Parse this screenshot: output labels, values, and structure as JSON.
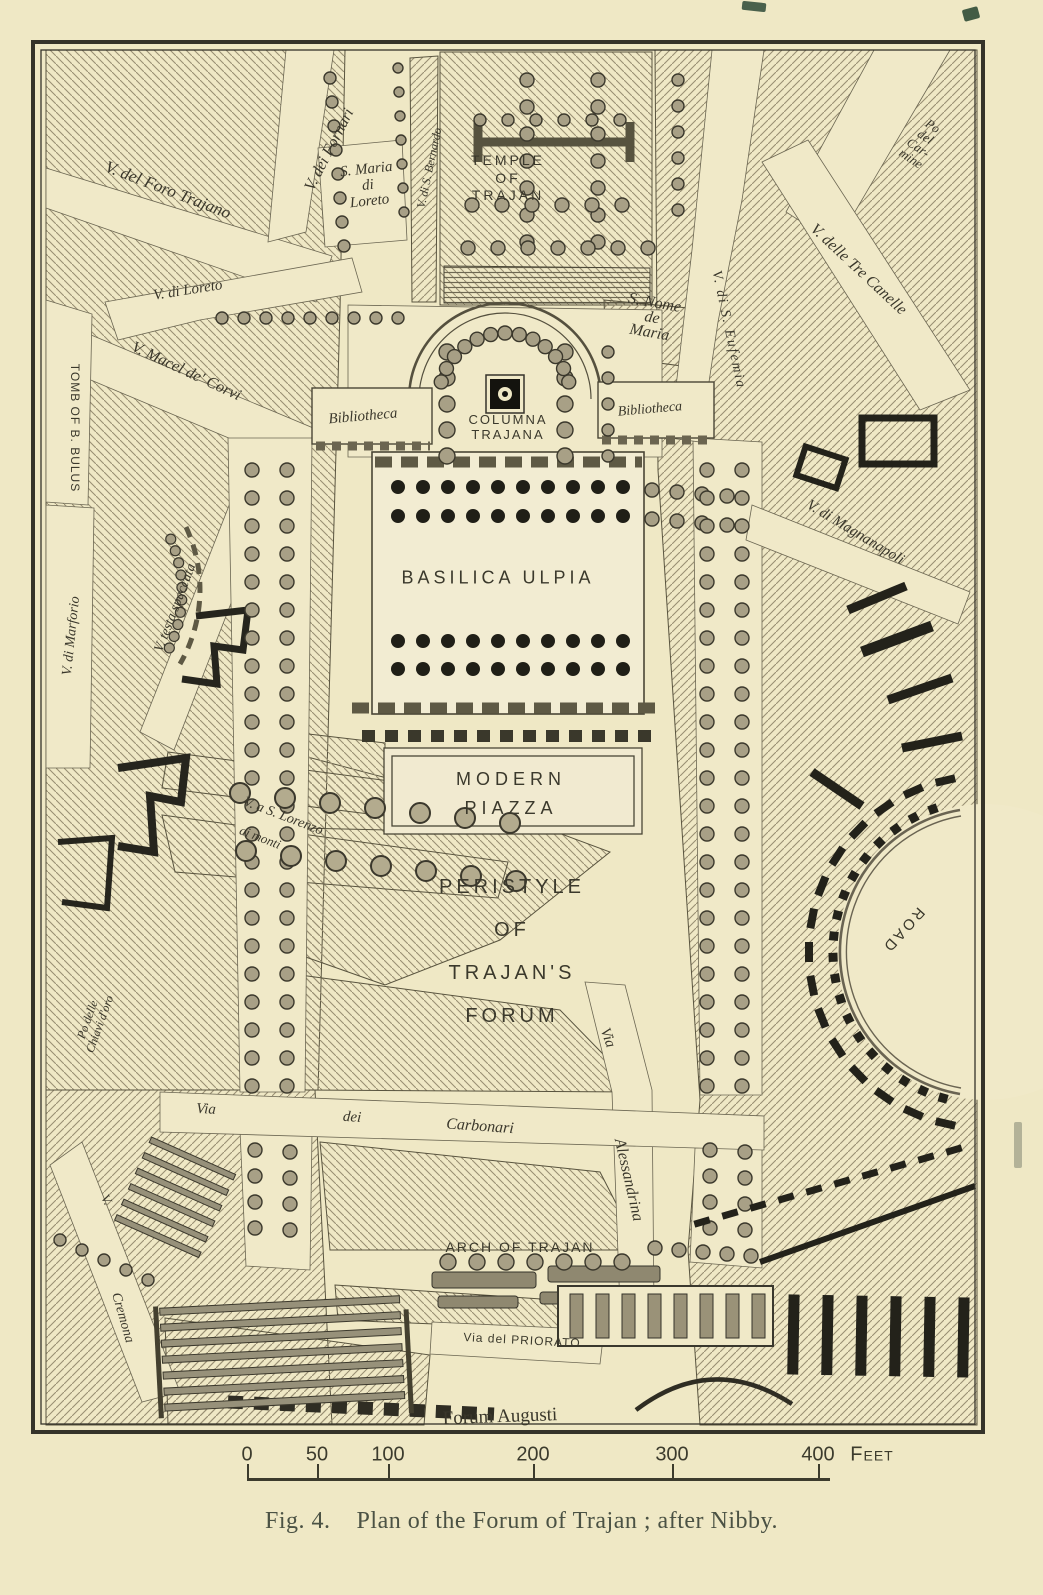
{
  "colors": {
    "paper": "#efe8c5",
    "ink": "#35332a",
    "caption_ink": "#4b5244",
    "hatch": "#978d72",
    "black_structures": "#23221a"
  },
  "figure": {
    "fig_label": "Fig. 4.",
    "caption": "Plan of the Forum of Trajan ; after Nibby."
  },
  "map": {
    "labels": [
      {
        "id": "foro-trajano",
        "text": "V. del Foro Trajano",
        "x": 168,
        "y": 190,
        "rot": 21,
        "size": 17,
        "style": "i"
      },
      {
        "id": "fornari",
        "text": "V. dei Fornari",
        "x": 330,
        "y": 150,
        "rot": -63,
        "size": 16,
        "style": "i"
      },
      {
        "id": "s-maria-di-loreto",
        "text": "S. Maria\ndi\nLoreto",
        "x": 368,
        "y": 186,
        "rot": -6,
        "size": 15,
        "style": "i",
        "lh": 1.05
      },
      {
        "id": "bernardo",
        "text": "V. di S. Bernardo",
        "x": 430,
        "y": 168,
        "rot": -78,
        "size": 12,
        "style": "i"
      },
      {
        "id": "temple-of-trajan",
        "text": "TEMPLE\nOF\nTRAJAN",
        "x": 508,
        "y": 178,
        "rot": 0,
        "size": 14,
        "style": "c",
        "ls": 3,
        "lh": 1.25
      },
      {
        "id": "po-del-carmine",
        "text": "Po\ndel\nCar-\nmine",
        "x": 922,
        "y": 142,
        "rot": 34,
        "size": 13,
        "style": "i",
        "lh": 1.0
      },
      {
        "id": "tre-canelle",
        "text": "V. delle Tre Canelle",
        "x": 858,
        "y": 270,
        "rot": 43,
        "size": 16,
        "style": "i"
      },
      {
        "id": "s-nome-de-maria",
        "text": "S. Nome\nde\nMaria",
        "x": 652,
        "y": 318,
        "rot": 10,
        "size": 16,
        "style": "i",
        "lh": 0.95
      },
      {
        "id": "eufemia",
        "text": "V. di S. Eufemia",
        "x": 728,
        "y": 330,
        "rot": 78,
        "size": 14,
        "style": "i",
        "ls": 2
      },
      {
        "id": "bibliotheca-west",
        "text": "Bibliotheca",
        "x": 363,
        "y": 417,
        "rot": -5,
        "size": 15,
        "style": "i"
      },
      {
        "id": "columna-trajana",
        "text": "COLUMNA\nTRAJANA",
        "x": 508,
        "y": 428,
        "rot": 0,
        "size": 13,
        "style": "c",
        "ls": 2,
        "lh": 1.15
      },
      {
        "id": "bibliotheca-east",
        "text": "Bibliotheca",
        "x": 650,
        "y": 410,
        "rot": -5,
        "size": 14,
        "style": "i"
      },
      {
        "id": "magnanapoli",
        "text": "V. di Magnanapoli",
        "x": 855,
        "y": 533,
        "rot": 31,
        "size": 15,
        "style": "i"
      },
      {
        "id": "tomb-of-b-bulus",
        "text": "TOMB OF B. BULUS",
        "x": 74,
        "y": 428,
        "rot": 90,
        "size": 12,
        "style": "c",
        "ls": 1
      },
      {
        "id": "macel-de-corvi",
        "text": "V. Macel de' Corvi",
        "x": 186,
        "y": 372,
        "rot": 25,
        "size": 16,
        "style": "i"
      },
      {
        "id": "v-di-loreto",
        "text": "V. di Loreto",
        "x": 188,
        "y": 291,
        "rot": -9,
        "size": 15,
        "style": "i"
      },
      {
        "id": "marforio",
        "text": "V. di Marforio",
        "x": 72,
        "y": 636,
        "rot": -84,
        "size": 14,
        "style": "i"
      },
      {
        "id": "testa-spaccata",
        "text": "V. testa spaccata",
        "x": 176,
        "y": 608,
        "rot": -69,
        "size": 14,
        "style": "i"
      },
      {
        "id": "basilica-ulpia",
        "text": "BASILICA ULPIA",
        "x": 498,
        "y": 578,
        "rot": 0,
        "size": 18,
        "style": "c",
        "ls": 4
      },
      {
        "id": "modern-piazza",
        "text": "MODERN\nPIAZZA",
        "x": 511,
        "y": 794,
        "rot": 0,
        "size": 18,
        "style": "c",
        "ls": 5,
        "lh": 1.6
      },
      {
        "id": "s-lorenzo",
        "text": "V. a S. Lorenzo",
        "x": 283,
        "y": 817,
        "rot": 21,
        "size": 14,
        "style": "i"
      },
      {
        "id": "ai-monti",
        "text": "ai monti",
        "x": 260,
        "y": 838,
        "rot": 21,
        "size": 13,
        "style": "i"
      },
      {
        "id": "peristyle",
        "text": "PERISTYLE\nOF\nTRAJAN'S\nFORUM",
        "x": 512,
        "y": 952,
        "rot": 0,
        "size": 20,
        "style": "c",
        "ls": 4,
        "lh": 2.15
      },
      {
        "id": "road",
        "text": "ROAD",
        "x": 903,
        "y": 930,
        "rot": 132,
        "size": 15,
        "style": "c",
        "ls": 3
      },
      {
        "id": "via-alessandrina-1",
        "text": "Via",
        "x": 607,
        "y": 1038,
        "rot": 70,
        "size": 15,
        "style": "i"
      },
      {
        "id": "via-alessandrina-2",
        "text": "Alessandrina",
        "x": 628,
        "y": 1180,
        "rot": 77,
        "size": 16,
        "style": "i"
      },
      {
        "id": "carbonari-via",
        "text": "Via",
        "x": 206,
        "y": 1110,
        "rot": 3,
        "size": 15,
        "style": "i"
      },
      {
        "id": "carbonari-dei",
        "text": "dei",
        "x": 352,
        "y": 1118,
        "rot": 4,
        "size": 15,
        "style": "i"
      },
      {
        "id": "carbonari",
        "text": "Carbonari",
        "x": 480,
        "y": 1127,
        "rot": 4,
        "size": 16,
        "style": "i"
      },
      {
        "id": "chiavi-doro",
        "text": "Po delle\nChiavi d'oro",
        "x": 94,
        "y": 1022,
        "rot": -70,
        "size": 12,
        "style": "i",
        "lh": 1.1
      },
      {
        "id": "arch-of-trajan",
        "text": "ARCH OF TRAJAN",
        "x": 520,
        "y": 1247,
        "rot": 0,
        "size": 14,
        "style": "c",
        "ls": 2
      },
      {
        "id": "priorato",
        "text": "Via del PRIORATO",
        "x": 522,
        "y": 1341,
        "rot": 3,
        "size": 12,
        "style": "c",
        "ls": 1
      },
      {
        "id": "cremona-v",
        "text": "V.",
        "x": 106,
        "y": 1200,
        "rot": 60,
        "size": 13,
        "style": "i"
      },
      {
        "id": "cremona",
        "text": "Cremona",
        "x": 122,
        "y": 1318,
        "rot": 74,
        "size": 14,
        "style": "i"
      },
      {
        "id": "forum-augusti",
        "text": "Forum Augusti",
        "x": 500,
        "y": 1417,
        "rot": -2,
        "size": 19,
        "style": "s"
      }
    ],
    "scale_bar": {
      "ticks": [
        {
          "label": "0",
          "x": 247
        },
        {
          "label": "50",
          "x": 317
        },
        {
          "label": "100",
          "x": 388
        },
        {
          "label": "200",
          "x": 533
        },
        {
          "label": "300",
          "x": 672
        },
        {
          "label": "400",
          "x": 818
        }
      ],
      "unit": "Feet",
      "unit_x": 872,
      "labels_y": 1455,
      "bar_y": 1478,
      "x_start": 247,
      "x_end": 830
    }
  }
}
